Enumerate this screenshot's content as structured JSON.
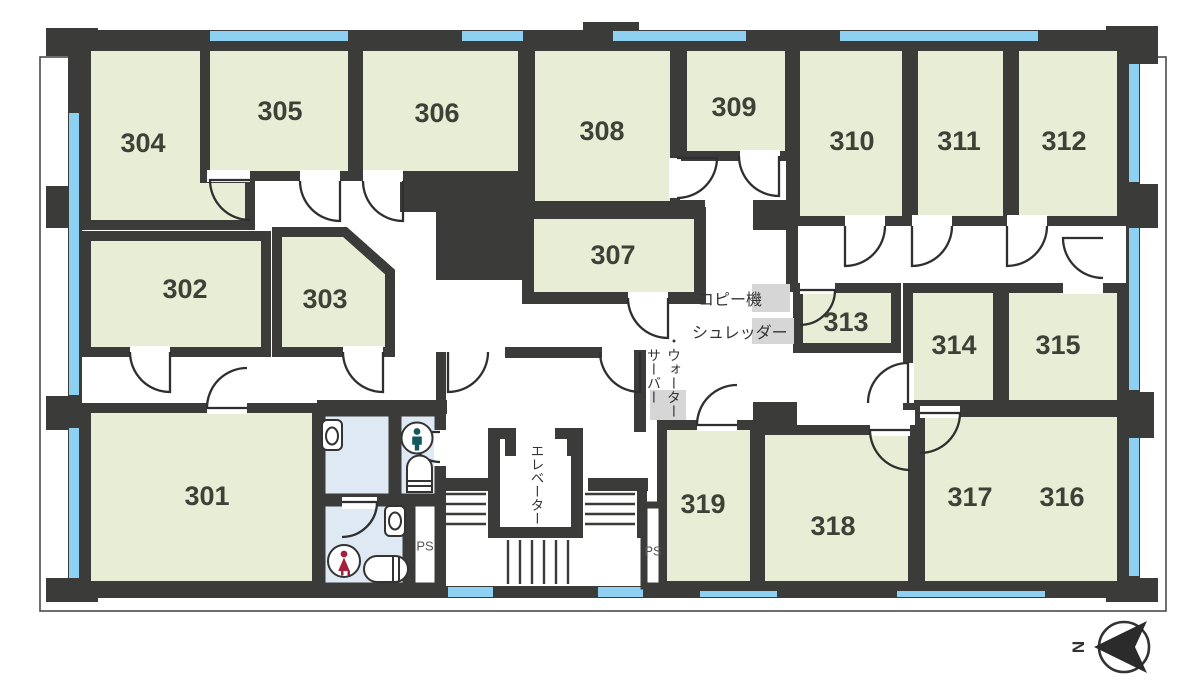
{
  "colors": {
    "wall": "#3b3b39",
    "room": "#e7eed5",
    "window": "#8ed0f1",
    "toilet": "#dfe9f4",
    "equipment": "#d6d6d6",
    "male": "#14575e",
    "female": "#a5203a",
    "text": "#3f4038",
    "line": "#2f2f2f"
  },
  "rooms": {
    "r301": {
      "label": "301"
    },
    "r302": {
      "label": "302"
    },
    "r303": {
      "label": "303"
    },
    "r304": {
      "label": "304"
    },
    "r305": {
      "label": "305"
    },
    "r306": {
      "label": "306"
    },
    "r307": {
      "label": "307"
    },
    "r308": {
      "label": "308"
    },
    "r309": {
      "label": "309"
    },
    "r310": {
      "label": "310"
    },
    "r311": {
      "label": "311"
    },
    "r312": {
      "label": "312"
    },
    "r313": {
      "label": "313"
    },
    "r314": {
      "label": "314"
    },
    "r315": {
      "label": "315"
    },
    "r316": {
      "label": "316"
    },
    "r317": {
      "label": "317"
    },
    "r318": {
      "label": "318"
    },
    "r319": {
      "label": "319"
    }
  },
  "facilities": {
    "copier": "コピー機",
    "shredder": "シュレッダー",
    "water_server_line1": "・ウォーター",
    "water_server_line2": "サーバー",
    "elevator": "エレベーター",
    "ps_left": "PS",
    "ps_right": "PS"
  },
  "compass": {
    "north": "N"
  }
}
